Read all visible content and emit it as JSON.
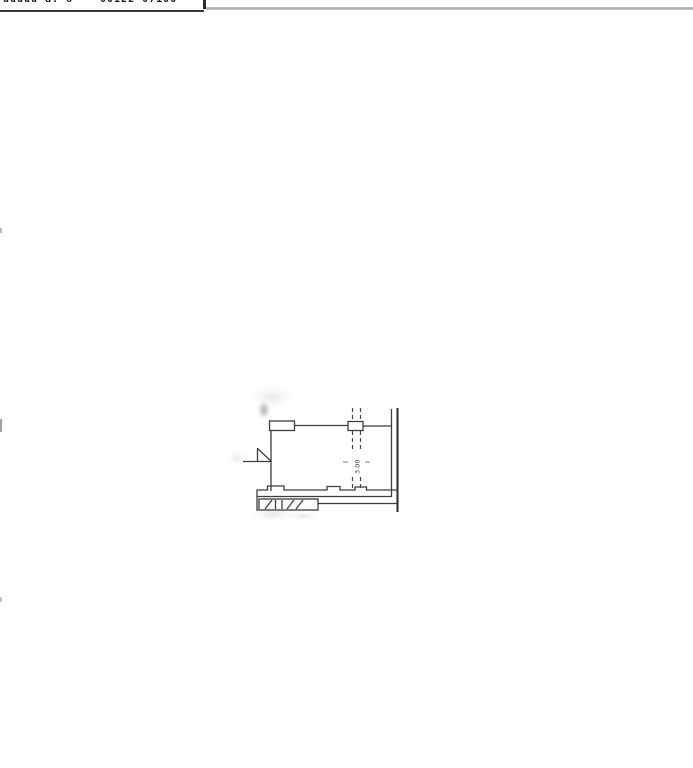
{
  "document": {
    "type": "scanned cadastral floor-plan sheet",
    "background_color": "#ffffff",
    "ink_color": "#3e3e3e"
  },
  "top_bar": {
    "left_fragment": "uuuuu a. o",
    "right_fragment": "00122 07100",
    "left_rule_color": "#3a3a3a",
    "right_rule_color": "#b0b0b0",
    "divider_color": "#2b2b2b"
  },
  "floor_plan": {
    "partition_label": "3.00",
    "elements": [
      "window-jamb-rectangle (top-left of room)",
      "top-wall-line",
      "pier-rectangle on dashed partition",
      "double-dashed vertical partition with rotated label 3.00",
      "double solid right wall (inner thin, outer thick)",
      "left wall with door-swing symbol",
      "stepped bottom wall with hatched band"
    ],
    "smudges": "gray scanner shadows near top-left corner, left of door, below bottom wall"
  }
}
